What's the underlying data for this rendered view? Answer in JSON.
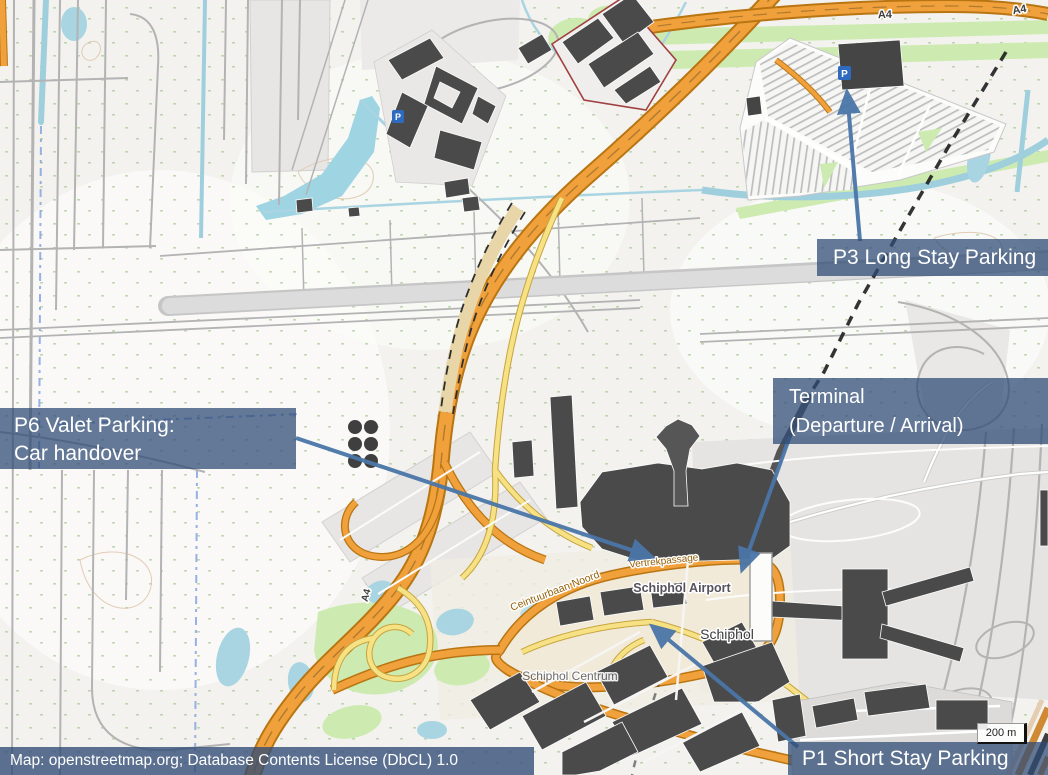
{
  "overlays": {
    "p6": {
      "line1": "P6 Valet Parking:",
      "line2": "Car handover"
    },
    "p3": {
      "label": "P3 Long Stay Parking"
    },
    "terminal": {
      "line1": "Terminal",
      "line2": "(Departure / Arrival)"
    },
    "p1": {
      "label": "P1 Short Stay Parking"
    }
  },
  "attribution": {
    "text": "Map: openstreetmap.org; Database Contents License (DbCL) 1.0"
  },
  "scale_bar": {
    "label": "200 m"
  },
  "map_labels": {
    "airport": "Schiphol Airport",
    "town": "Schiphol",
    "centrum": "Schiphol Centrum",
    "ring_road": "Ceintuurbaan Noord",
    "departure_road": "Vertrekpassage",
    "a4": "A4",
    "parking_icon": "P"
  },
  "colors": {
    "label_background": "#2f4c75",
    "arrow": "#4a76a8",
    "motorway": "#f0a13c",
    "secondary_road": "#f6e284",
    "water": "#a9d5e2",
    "grass": "#cdebb0",
    "building": "#4a4a4a",
    "runway": "#dcdcdc"
  }
}
